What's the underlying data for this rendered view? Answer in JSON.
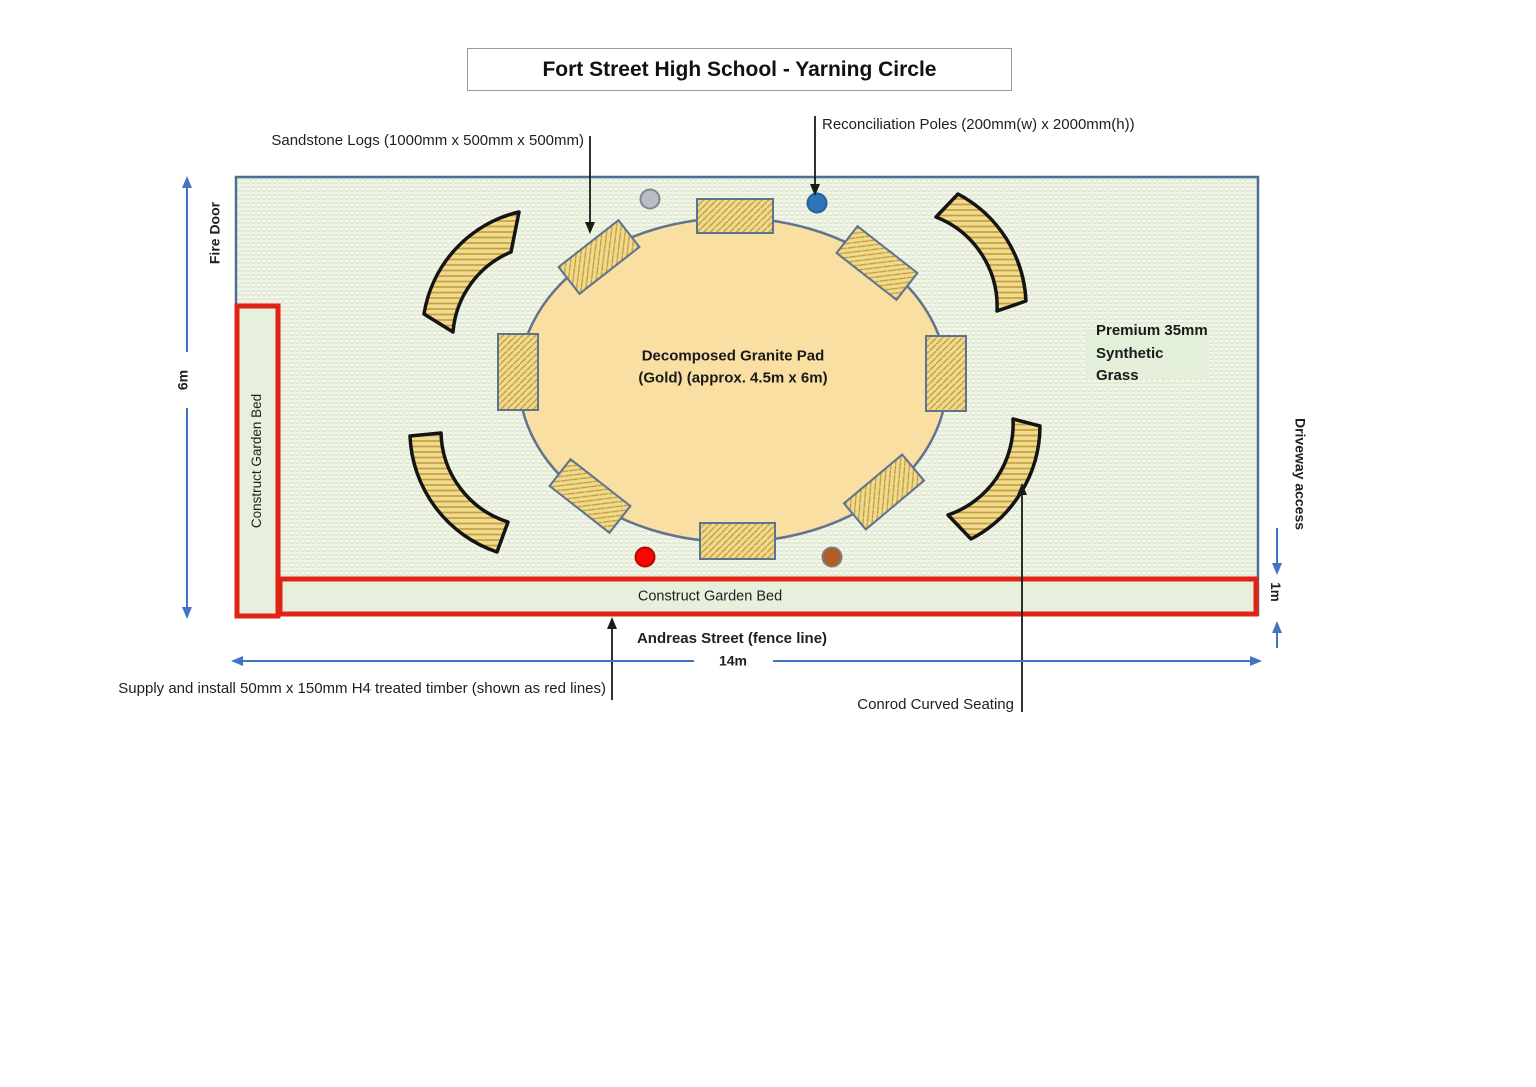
{
  "title": "Fort Street High School - Yarning Circle",
  "annotations": {
    "sandstone_logs": "Sandstone Logs (1000mm x 500mm x 500mm)",
    "reconciliation_poles": "Reconciliation Poles (200mm(w) x 2000mm(h))",
    "timber_note": "Supply and install 50mm x 150mm H4 treated timber (shown as red lines)",
    "curved_seating": "Conrod Curved Seating"
  },
  "areas": {
    "granite_pad_line1": "Decomposed Granite Pad",
    "granite_pad_line2": "(Gold) (approx. 4.5m x 6m)",
    "grass_line1": "Premium 35mm",
    "grass_line2": "Synthetic Grass",
    "garden_bed_left": "Construct Garden Bed",
    "garden_bed_bottom": "Construct Garden Bed"
  },
  "edges": {
    "fire_door": "Fire Door",
    "driveway": "Driveway access",
    "street": "Andreas Street (fence line)"
  },
  "dimensions": {
    "site_height": "6m",
    "site_width": "14m",
    "bed_depth": "1m"
  },
  "counts": {
    "sandstone_logs": 8,
    "curved_seats": 4,
    "reconciliation_pole_dots": 4
  },
  "poles": [
    {
      "name": "grey-pole",
      "color": "#b9bdc6",
      "stroke": "#82878f"
    },
    {
      "name": "blue-pole",
      "color": "#2e75b6",
      "stroke": "#2361a0"
    },
    {
      "name": "red-pole",
      "color": "#fe0400",
      "stroke": "#b00b06"
    },
    {
      "name": "brown-pole",
      "color": "#b05e26",
      "stroke": "#7c7c7c"
    }
  ],
  "colors": {
    "timber_red": "#e02414",
    "grass_base": "#f2f5e9",
    "grass_wave": "#dbe5ca",
    "granite_gold": "#f9dfa2",
    "log_fill": "#f1d98e",
    "hatch_stroke": "#c2a142",
    "outline_blue_grey": "#5d7390",
    "dimension_blue": "#4473c5",
    "garden_bed_fill": "#e7f0dc"
  }
}
